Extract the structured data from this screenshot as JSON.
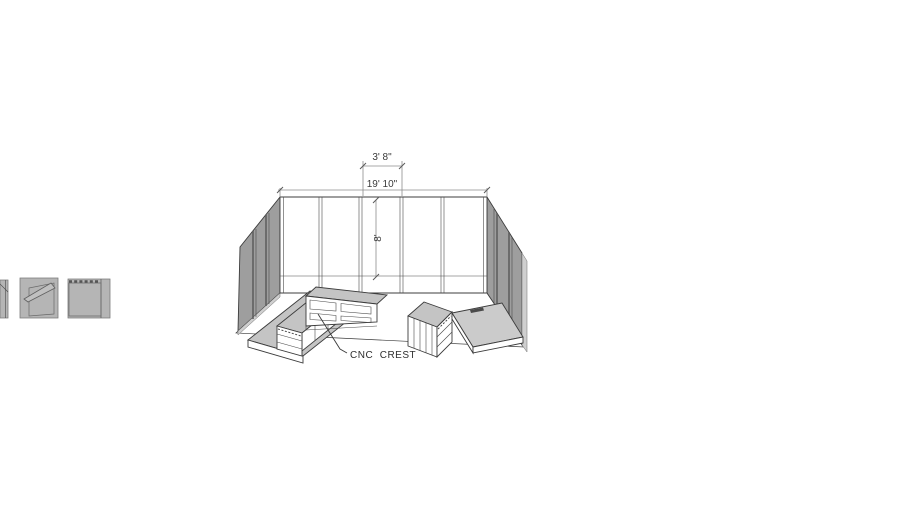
{
  "viewport": {
    "width": 910,
    "height": 512,
    "background": "#ffffff"
  },
  "annotations": {
    "dim_bay_width": "3' 8\"",
    "dim_wall_length": "19' 10\"",
    "dim_wall_height": "8'",
    "cabinet_label": "CNC  CREST"
  },
  "colors": {
    "line": "#3c3c3c",
    "dimension_line": "#8c8c8c",
    "dimension_text": "#3a3a3a",
    "wall_shade": "#9e9e9e",
    "wall_panel_gap": "#5f5f5f",
    "edge_highlight": "#cfcfcf",
    "surface_top": "#c4c4c4",
    "thumbnail_fill": "#b5b5b5",
    "panel_mark": "#4a4a4a"
  }
}
